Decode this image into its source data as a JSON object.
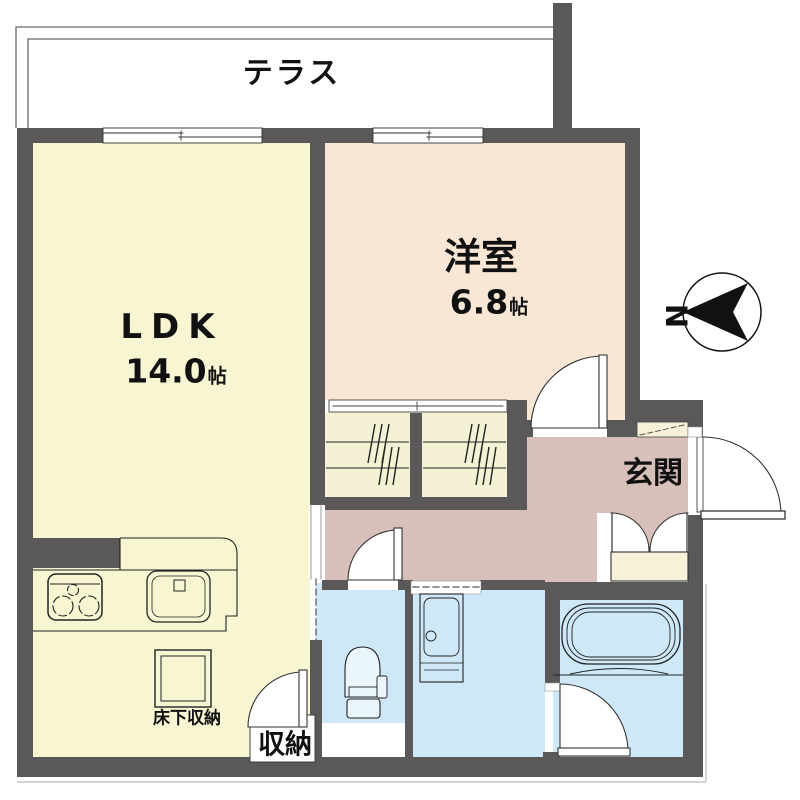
{
  "rooms": {
    "terrace": {
      "label": "テラス"
    },
    "ldk": {
      "label": "LDK",
      "size": "14.0",
      "unit": "帖"
    },
    "western_room": {
      "label": "洋室",
      "size": "6.8",
      "unit": "帖"
    },
    "entrance": {
      "label": "玄関"
    },
    "underfloor_storage": {
      "label": "床下収納"
    },
    "storage": {
      "label": "収納"
    }
  },
  "compass": {
    "north_label": "N"
  },
  "colors": {
    "wall": "#5a5858",
    "ldk_floor": "#f8f6d2",
    "western_floor": "#f9e7d6",
    "closet_floor": "#f4f1d4",
    "hall_floor": "#d8c0ba",
    "wet_floor": "#cfe8f7",
    "fixture_fill": "#eaf5fc",
    "cabinet_fill": "#f6f1d7",
    "door_white": "#ffffff",
    "line": "#222222",
    "text": "#111111"
  }
}
